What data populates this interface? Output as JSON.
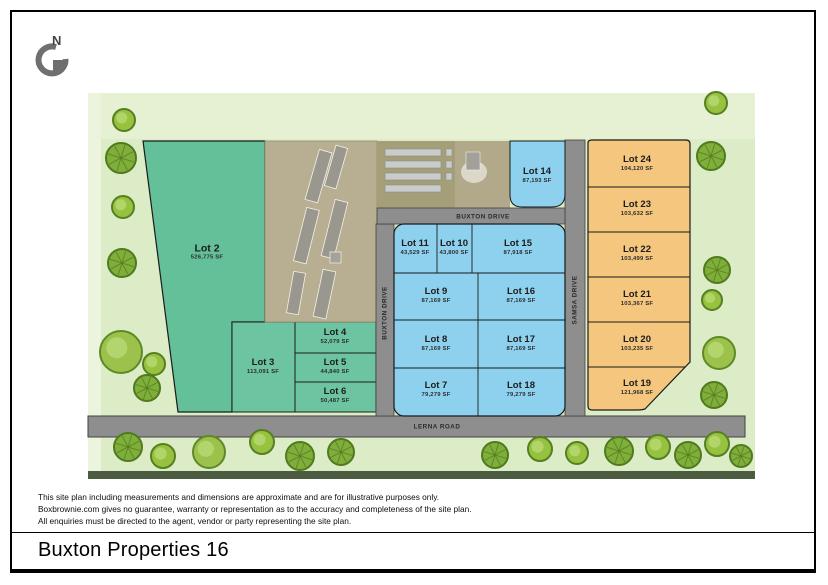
{
  "title": "Buxton Properties 16",
  "north_label": "N",
  "disclaimer": {
    "line1": "This site plan including measurements and dimensions are approximate and are for illustrative purposes only.",
    "line2": "Boxbrownie.com gives no guarantee, warranty or representation as to the accuracy and completeness of the site plan.",
    "line3": "All enquiries must be directed to the agent, vendor or party representing the site plan."
  },
  "roads": {
    "buxton_drive_top": "BUXTON DRIVE",
    "buxton_drive_vertical": "BUXTON DRIVE",
    "samsa_drive": "SAMSA DRIVE",
    "lerna_road": "LERNA ROAD"
  },
  "lots": {
    "lot2": {
      "name": "Lot 2",
      "area": "526,775 SF",
      "color": "#63c099"
    },
    "lot3": {
      "name": "Lot 3",
      "area": "113,091 SF",
      "color": "#6cc5a0"
    },
    "lot4": {
      "name": "Lot 4",
      "area": "52,079 SF",
      "color": "#6cc5a0"
    },
    "lot5": {
      "name": "Lot 5",
      "area": "44,840 SF",
      "color": "#6cc5a0"
    },
    "lot6": {
      "name": "Lot 6",
      "area": "50,487 SF",
      "color": "#6cc5a0"
    },
    "lot7": {
      "name": "Lot 7",
      "area": "79,279 SF",
      "color": "#8ed1ee"
    },
    "lot8": {
      "name": "Lot 8",
      "area": "87,169 SF",
      "color": "#8ed1ee"
    },
    "lot9": {
      "name": "Lot 9",
      "area": "87,169 SF",
      "color": "#8ed1ee"
    },
    "lot10": {
      "name": "Lot 10",
      "area": "43,800 SF",
      "color": "#8ed1ee"
    },
    "lot11": {
      "name": "Lot 11",
      "area": "43,529 SF",
      "color": "#8ed1ee"
    },
    "lot14": {
      "name": "Lot 14",
      "area": "87,193 SF",
      "color": "#8ed1ee"
    },
    "lot15": {
      "name": "Lot 15",
      "area": "87,918 SF",
      "color": "#8ed1ee"
    },
    "lot16": {
      "name": "Lot 16",
      "area": "87,169 SF",
      "color": "#8ed1ee"
    },
    "lot17": {
      "name": "Lot 17",
      "area": "87,169 SF",
      "color": "#8ed1ee"
    },
    "lot18": {
      "name": "Lot 18",
      "area": "79,279 SF",
      "color": "#8ed1ee"
    },
    "lot19": {
      "name": "Lot 19",
      "area": "121,968 SF",
      "color": "#f4c67e"
    },
    "lot20": {
      "name": "Lot 20",
      "area": "103,235 SF",
      "color": "#f4c67e"
    },
    "lot21": {
      "name": "Lot 21",
      "area": "103,367 SF",
      "color": "#f4c67e"
    },
    "lot22": {
      "name": "Lot 22",
      "area": "103,499 SF",
      "color": "#f4c67e"
    },
    "lot23": {
      "name": "Lot 23",
      "area": "103,632 SF",
      "color": "#f4c67e"
    },
    "lot24": {
      "name": "Lot 24",
      "area": "104,120 SF",
      "color": "#f4c67e"
    }
  },
  "colors": {
    "green_lot": "#63c099",
    "blue_lot": "#8ed1ee",
    "orange_lot": "#f4c67e",
    "road_gray": "#8e8e8e",
    "map_background": "#dcecc7"
  },
  "trees": [
    {
      "x": 124,
      "y": 120,
      "r": 11,
      "type": "A"
    },
    {
      "x": 121,
      "y": 158,
      "r": 15,
      "type": "B"
    },
    {
      "x": 123,
      "y": 207,
      "r": 11,
      "type": "A"
    },
    {
      "x": 122,
      "y": 263,
      "r": 14,
      "type": "B"
    },
    {
      "x": 121,
      "y": 352,
      "r": 21,
      "type": "C"
    },
    {
      "x": 154,
      "y": 364,
      "r": 11,
      "type": "A"
    },
    {
      "x": 147,
      "y": 388,
      "r": 13,
      "type": "B"
    },
    {
      "x": 716,
      "y": 103,
      "r": 11,
      "type": "A"
    },
    {
      "x": 711,
      "y": 156,
      "r": 14,
      "type": "B"
    },
    {
      "x": 717,
      "y": 270,
      "r": 13,
      "type": "B"
    },
    {
      "x": 712,
      "y": 300,
      "r": 10,
      "type": "A"
    },
    {
      "x": 719,
      "y": 353,
      "r": 16,
      "type": "C"
    },
    {
      "x": 714,
      "y": 395,
      "r": 13,
      "type": "B"
    },
    {
      "x": 128,
      "y": 447,
      "r": 14,
      "type": "B"
    },
    {
      "x": 163,
      "y": 456,
      "r": 12,
      "type": "A"
    },
    {
      "x": 209,
      "y": 452,
      "r": 16,
      "type": "C"
    },
    {
      "x": 262,
      "y": 442,
      "r": 12,
      "type": "A"
    },
    {
      "x": 300,
      "y": 456,
      "r": 14,
      "type": "B"
    },
    {
      "x": 341,
      "y": 452,
      "r": 13,
      "type": "B"
    },
    {
      "x": 495,
      "y": 455,
      "r": 13,
      "type": "B"
    },
    {
      "x": 540,
      "y": 449,
      "r": 12,
      "type": "A"
    },
    {
      "x": 577,
      "y": 453,
      "r": 11,
      "type": "A"
    },
    {
      "x": 619,
      "y": 451,
      "r": 14,
      "type": "B"
    },
    {
      "x": 658,
      "y": 447,
      "r": 12,
      "type": "A"
    },
    {
      "x": 688,
      "y": 455,
      "r": 13,
      "type": "B"
    },
    {
      "x": 717,
      "y": 444,
      "r": 12,
      "type": "A"
    },
    {
      "x": 741,
      "y": 456,
      "r": 11,
      "type": "B"
    }
  ]
}
